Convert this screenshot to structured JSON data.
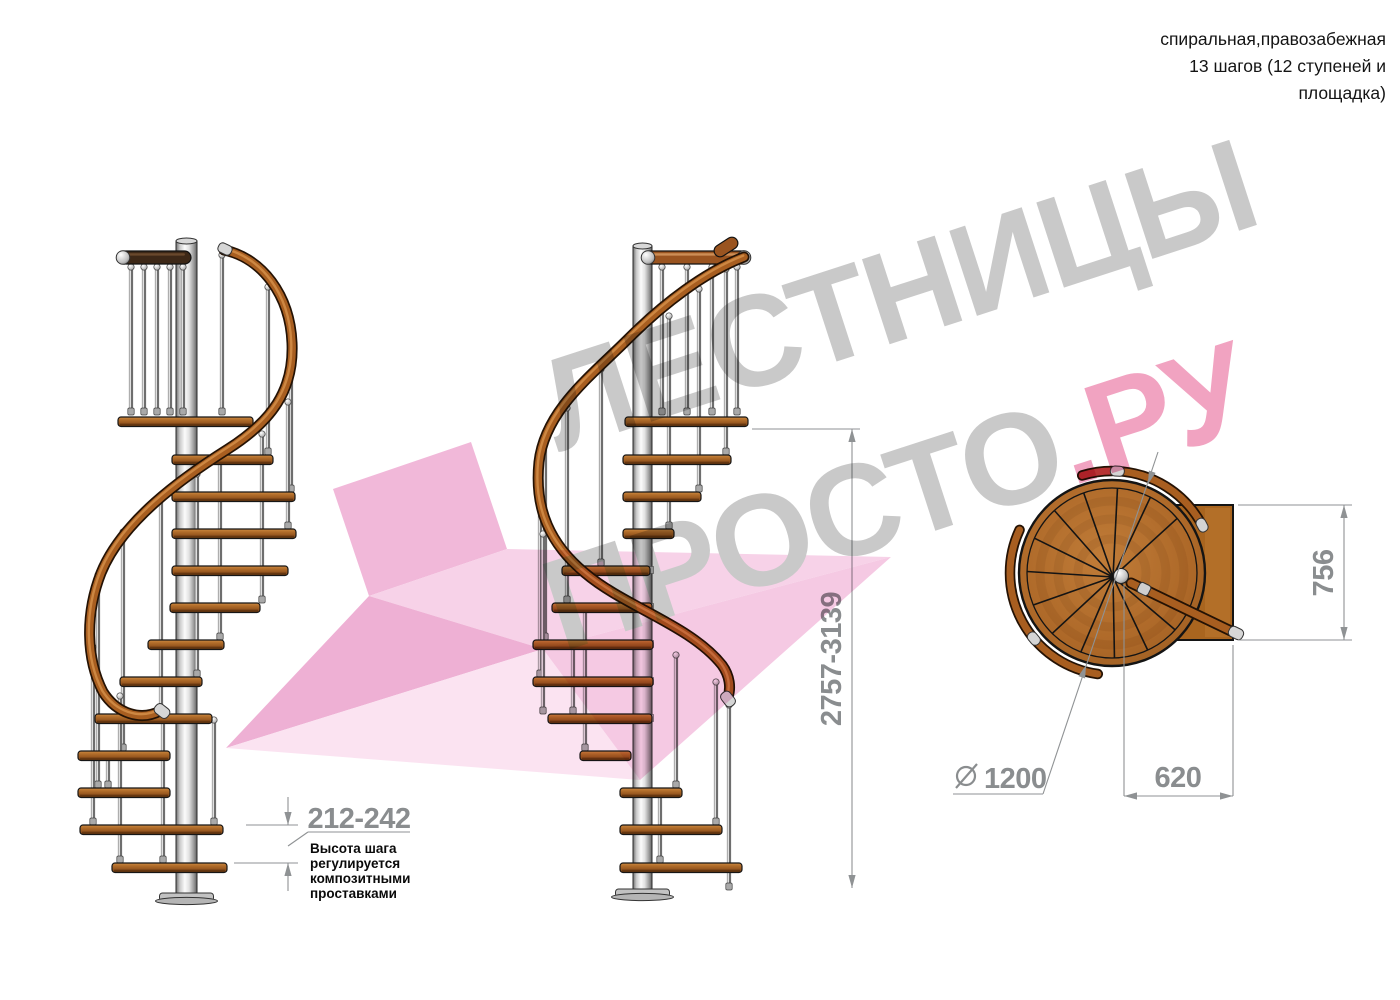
{
  "header": {
    "line1": "спиральная,правозабежная",
    "line2": "13 шагов (12 ступеней и",
    "line3": "площадка)"
  },
  "dimensions": {
    "step_height": "212-242",
    "total_height": "2757-3139",
    "platform_depth": "756",
    "platform_width": "620",
    "diameter_symbol": "∅",
    "diameter": "1200"
  },
  "note": {
    "lines": [
      "Высота шага",
      "регулируется",
      "композитными",
      "проставками"
    ]
  },
  "watermark": {
    "word1": "ЛЕСТНИЦЫ",
    "word2": "ПРОСТО",
    "word3": ".РУ"
  },
  "colors": {
    "wood": "#b26d2a",
    "wood_dark": "#6f3c12",
    "handrail": "#a85e20",
    "dark_walnut": "#3d2817",
    "pole_metal": "#c8c8c8",
    "dimension_gray": "#8a8d8f",
    "annotation_black": "#0a0a0a",
    "watermark_gray": "#c9c9c9",
    "watermark_pink": "#f1a3c1",
    "arrow_pink": "#f7d2e8",
    "handrail_red": "#b73434"
  }
}
